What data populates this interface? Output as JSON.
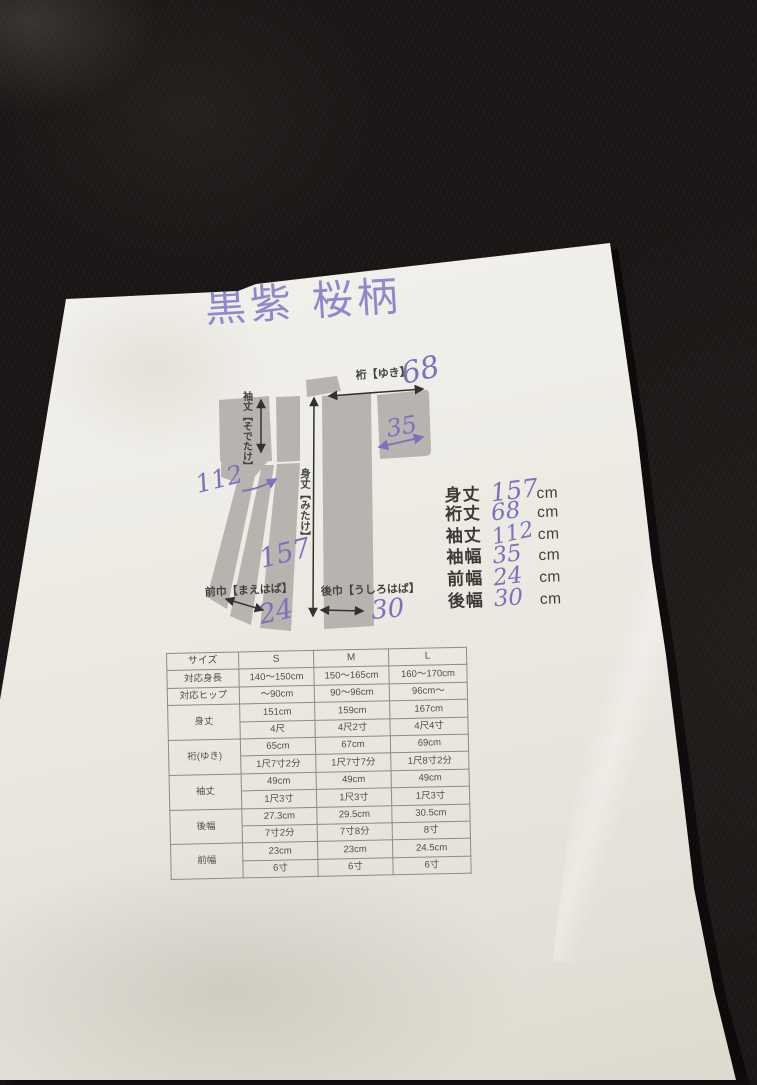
{
  "photo": {
    "fabric_color": "#181514",
    "paper_color": "#efede7",
    "ink_purple": "#7b72bb",
    "diagram_gray": "#b7b3af"
  },
  "title": {
    "text": "黒紫 桜柄"
  },
  "diagram": {
    "labels": {
      "yuki": "裄【ゆき】",
      "sodetake": "袖丈【そでたけ】",
      "mitake": "身丈【みたけ】",
      "maehaba": "前巾【まえはば】",
      "ushirohaba": "後巾【うしろはば】"
    },
    "annotations": {
      "yuki": "68",
      "sodehaba": "35",
      "sodetake": "112",
      "mitake": "157",
      "maehaba": "24",
      "ushirohaba": "30"
    }
  },
  "measurements": {
    "rows": [
      {
        "label": "身丈",
        "value": "157",
        "unit": "cm"
      },
      {
        "label": "裄丈",
        "value": "68",
        "unit": "cm"
      },
      {
        "label": "袖丈",
        "value": "112",
        "unit": "cm"
      },
      {
        "label": "袖幅",
        "value": "35",
        "unit": "cm"
      },
      {
        "label": "前幅",
        "value": "24",
        "unit": "cm"
      },
      {
        "label": "後幅",
        "value": "30",
        "unit": "cm"
      }
    ]
  },
  "size_table": {
    "header": [
      "サイズ",
      "S",
      "M",
      "L"
    ],
    "rows": [
      {
        "label": "対応身長",
        "values": [
          "140〜150cm",
          "150〜165cm",
          "160〜170cm"
        ]
      },
      {
        "label": "対応ヒップ",
        "values": [
          "〜90cm",
          "90〜96cm",
          "96cm〜"
        ]
      },
      {
        "label": "身丈",
        "cm": [
          "151cm",
          "159cm",
          "167cm"
        ],
        "shaku": [
          "4尺",
          "4尺2寸",
          "4尺4寸"
        ]
      },
      {
        "label": "裄(ゆき)",
        "cm": [
          "65cm",
          "67cm",
          "69cm"
        ],
        "shaku": [
          "1尺7寸2分",
          "1尺7寸7分",
          "1尺8寸2分"
        ]
      },
      {
        "label": "袖丈",
        "cm": [
          "49cm",
          "49cm",
          "49cm"
        ],
        "shaku": [
          "1尺3寸",
          "1尺3寸",
          "1尺3寸"
        ]
      },
      {
        "label": "後幅",
        "cm": [
          "27.3cm",
          "29.5cm",
          "30.5cm"
        ],
        "shaku": [
          "7寸2分",
          "7寸8分",
          "8寸"
        ]
      },
      {
        "label": "前幅",
        "cm": [
          "23cm",
          "23cm",
          "24.5cm"
        ],
        "shaku": [
          "6寸",
          "6寸",
          "6寸"
        ]
      }
    ]
  }
}
